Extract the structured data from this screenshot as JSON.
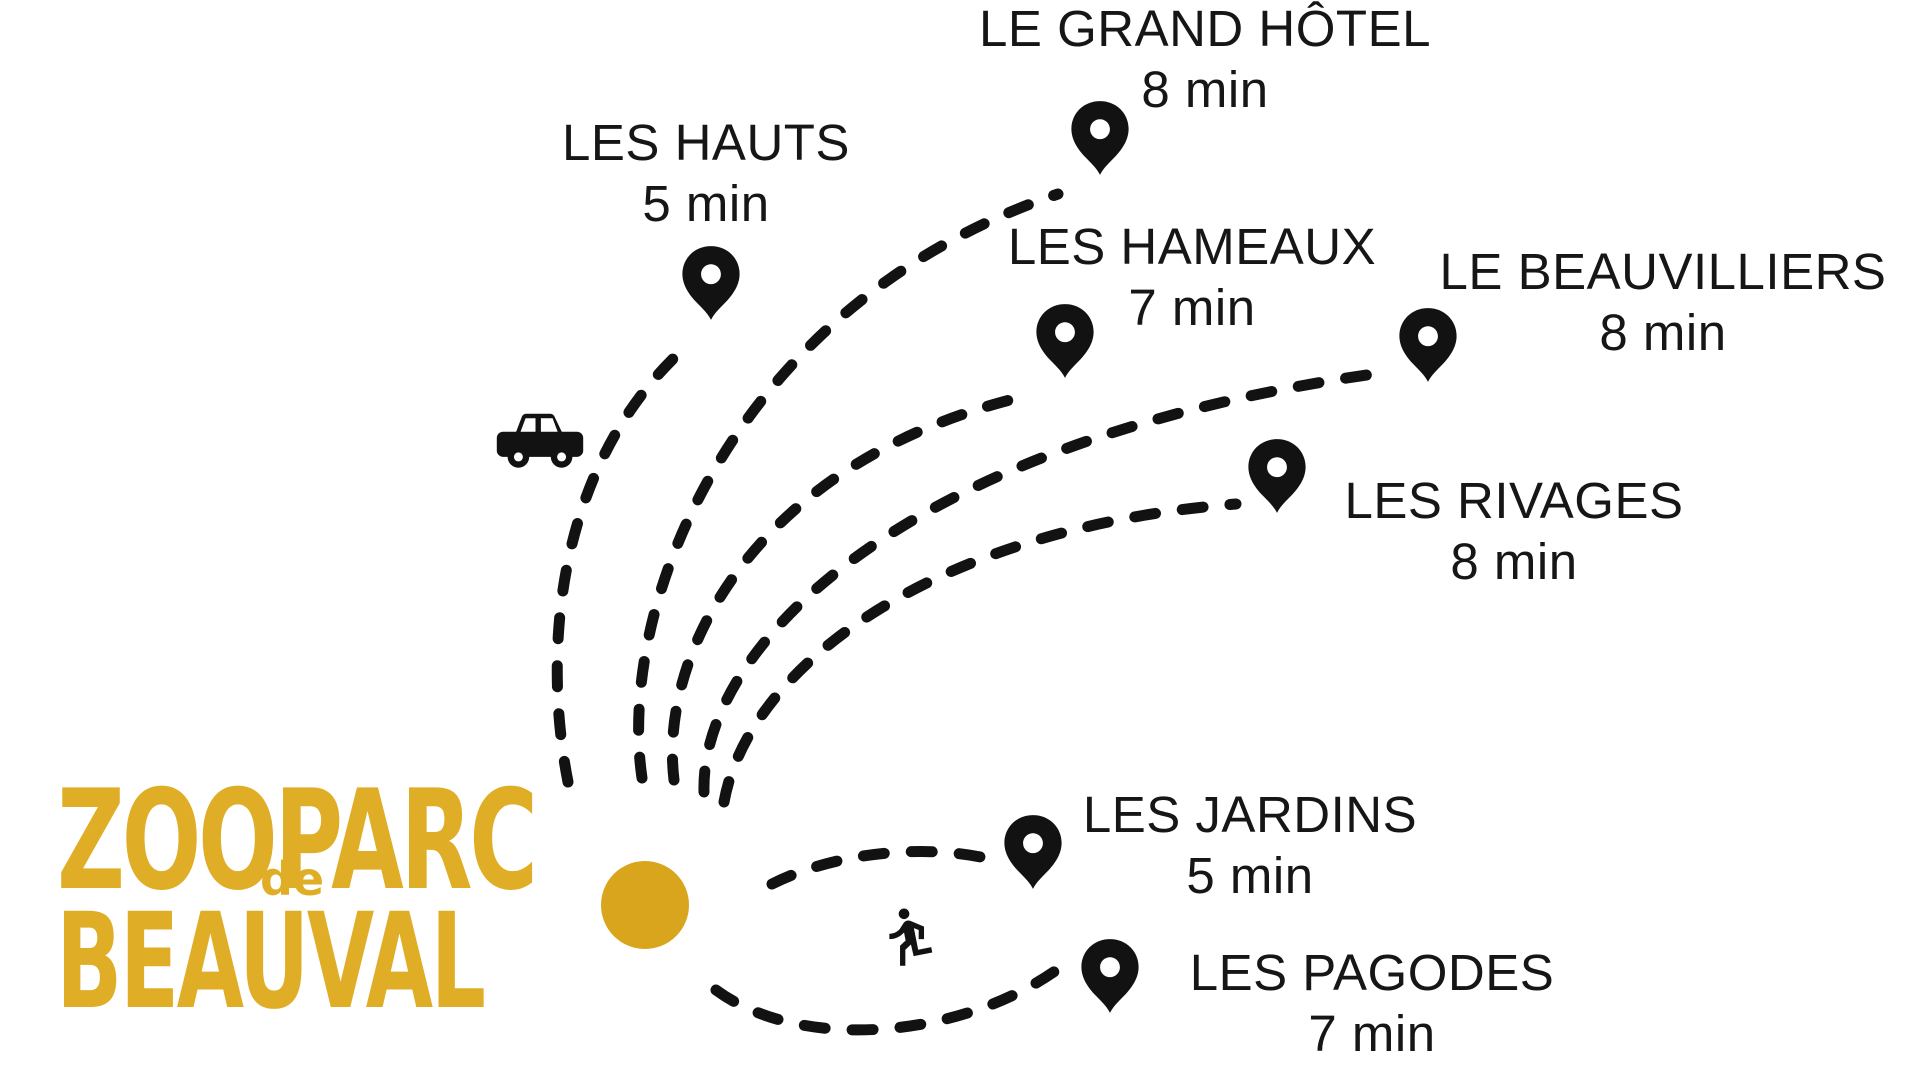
{
  "logo": {
    "line1": "ZOOPARC",
    "de": "de",
    "line2": "BEAUVAL"
  },
  "colors": {
    "brand_gold": "#e0ae26",
    "dot_gold": "#d8a51c",
    "ink": "#121212"
  },
  "icons": {
    "drive": "car-icon",
    "walk": "walking-person-icon",
    "marker": "map-pin-icon",
    "origin": "zoo-origin-dot"
  },
  "destinations": [
    {
      "name": "LE GRAND HÔTEL",
      "time": "8 min",
      "mode": "drive"
    },
    {
      "name": "LES HAUTS",
      "time": "5 min",
      "mode": "drive"
    },
    {
      "name": "LES HAMEAUX",
      "time": "7 min",
      "mode": "drive"
    },
    {
      "name": "LE BEAUVILLIERS",
      "time": "8 min",
      "mode": "drive"
    },
    {
      "name": "LES RIVAGES",
      "time": "8 min",
      "mode": "drive"
    },
    {
      "name": "LES JARDINS",
      "time": "5 min",
      "mode": "walk"
    },
    {
      "name": "LES PAGODES",
      "time": "7 min",
      "mode": "walk"
    }
  ]
}
